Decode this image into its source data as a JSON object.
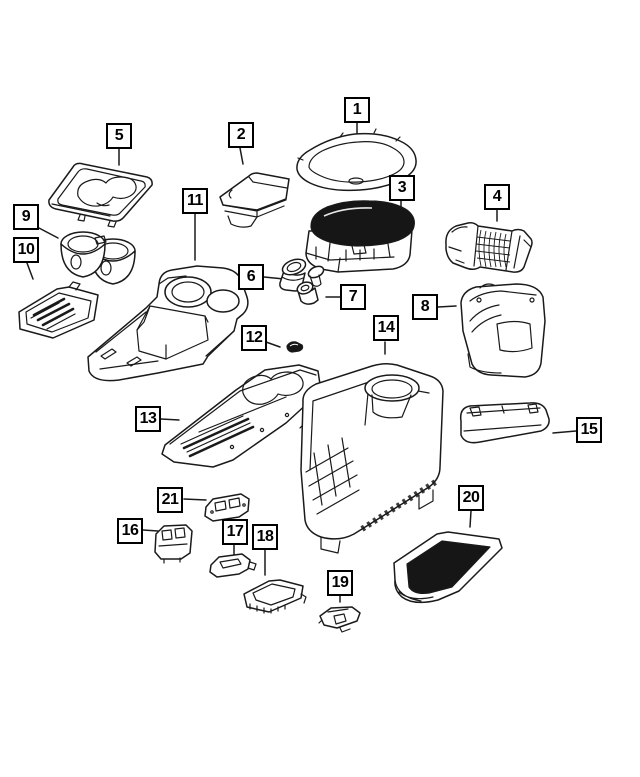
{
  "colors": {
    "background": "#ffffff",
    "line_art": "#1a1a1a",
    "callout_border": "#000000",
    "callout_text": "#000000",
    "dark_fill": "#161616"
  },
  "callouts": [
    {
      "label": "1"
    },
    {
      "label": "2"
    },
    {
      "label": "3"
    },
    {
      "label": "4"
    },
    {
      "label": "5"
    },
    {
      "label": "6"
    },
    {
      "label": "7"
    },
    {
      "label": "8"
    },
    {
      "label": "9"
    },
    {
      "label": "10"
    },
    {
      "label": "11"
    },
    {
      "label": "12"
    },
    {
      "label": "13"
    },
    {
      "label": "14"
    },
    {
      "label": "15"
    },
    {
      "label": "16"
    },
    {
      "label": "17"
    },
    {
      "label": "18"
    },
    {
      "label": "19"
    },
    {
      "label": "20"
    },
    {
      "label": "21"
    }
  ]
}
